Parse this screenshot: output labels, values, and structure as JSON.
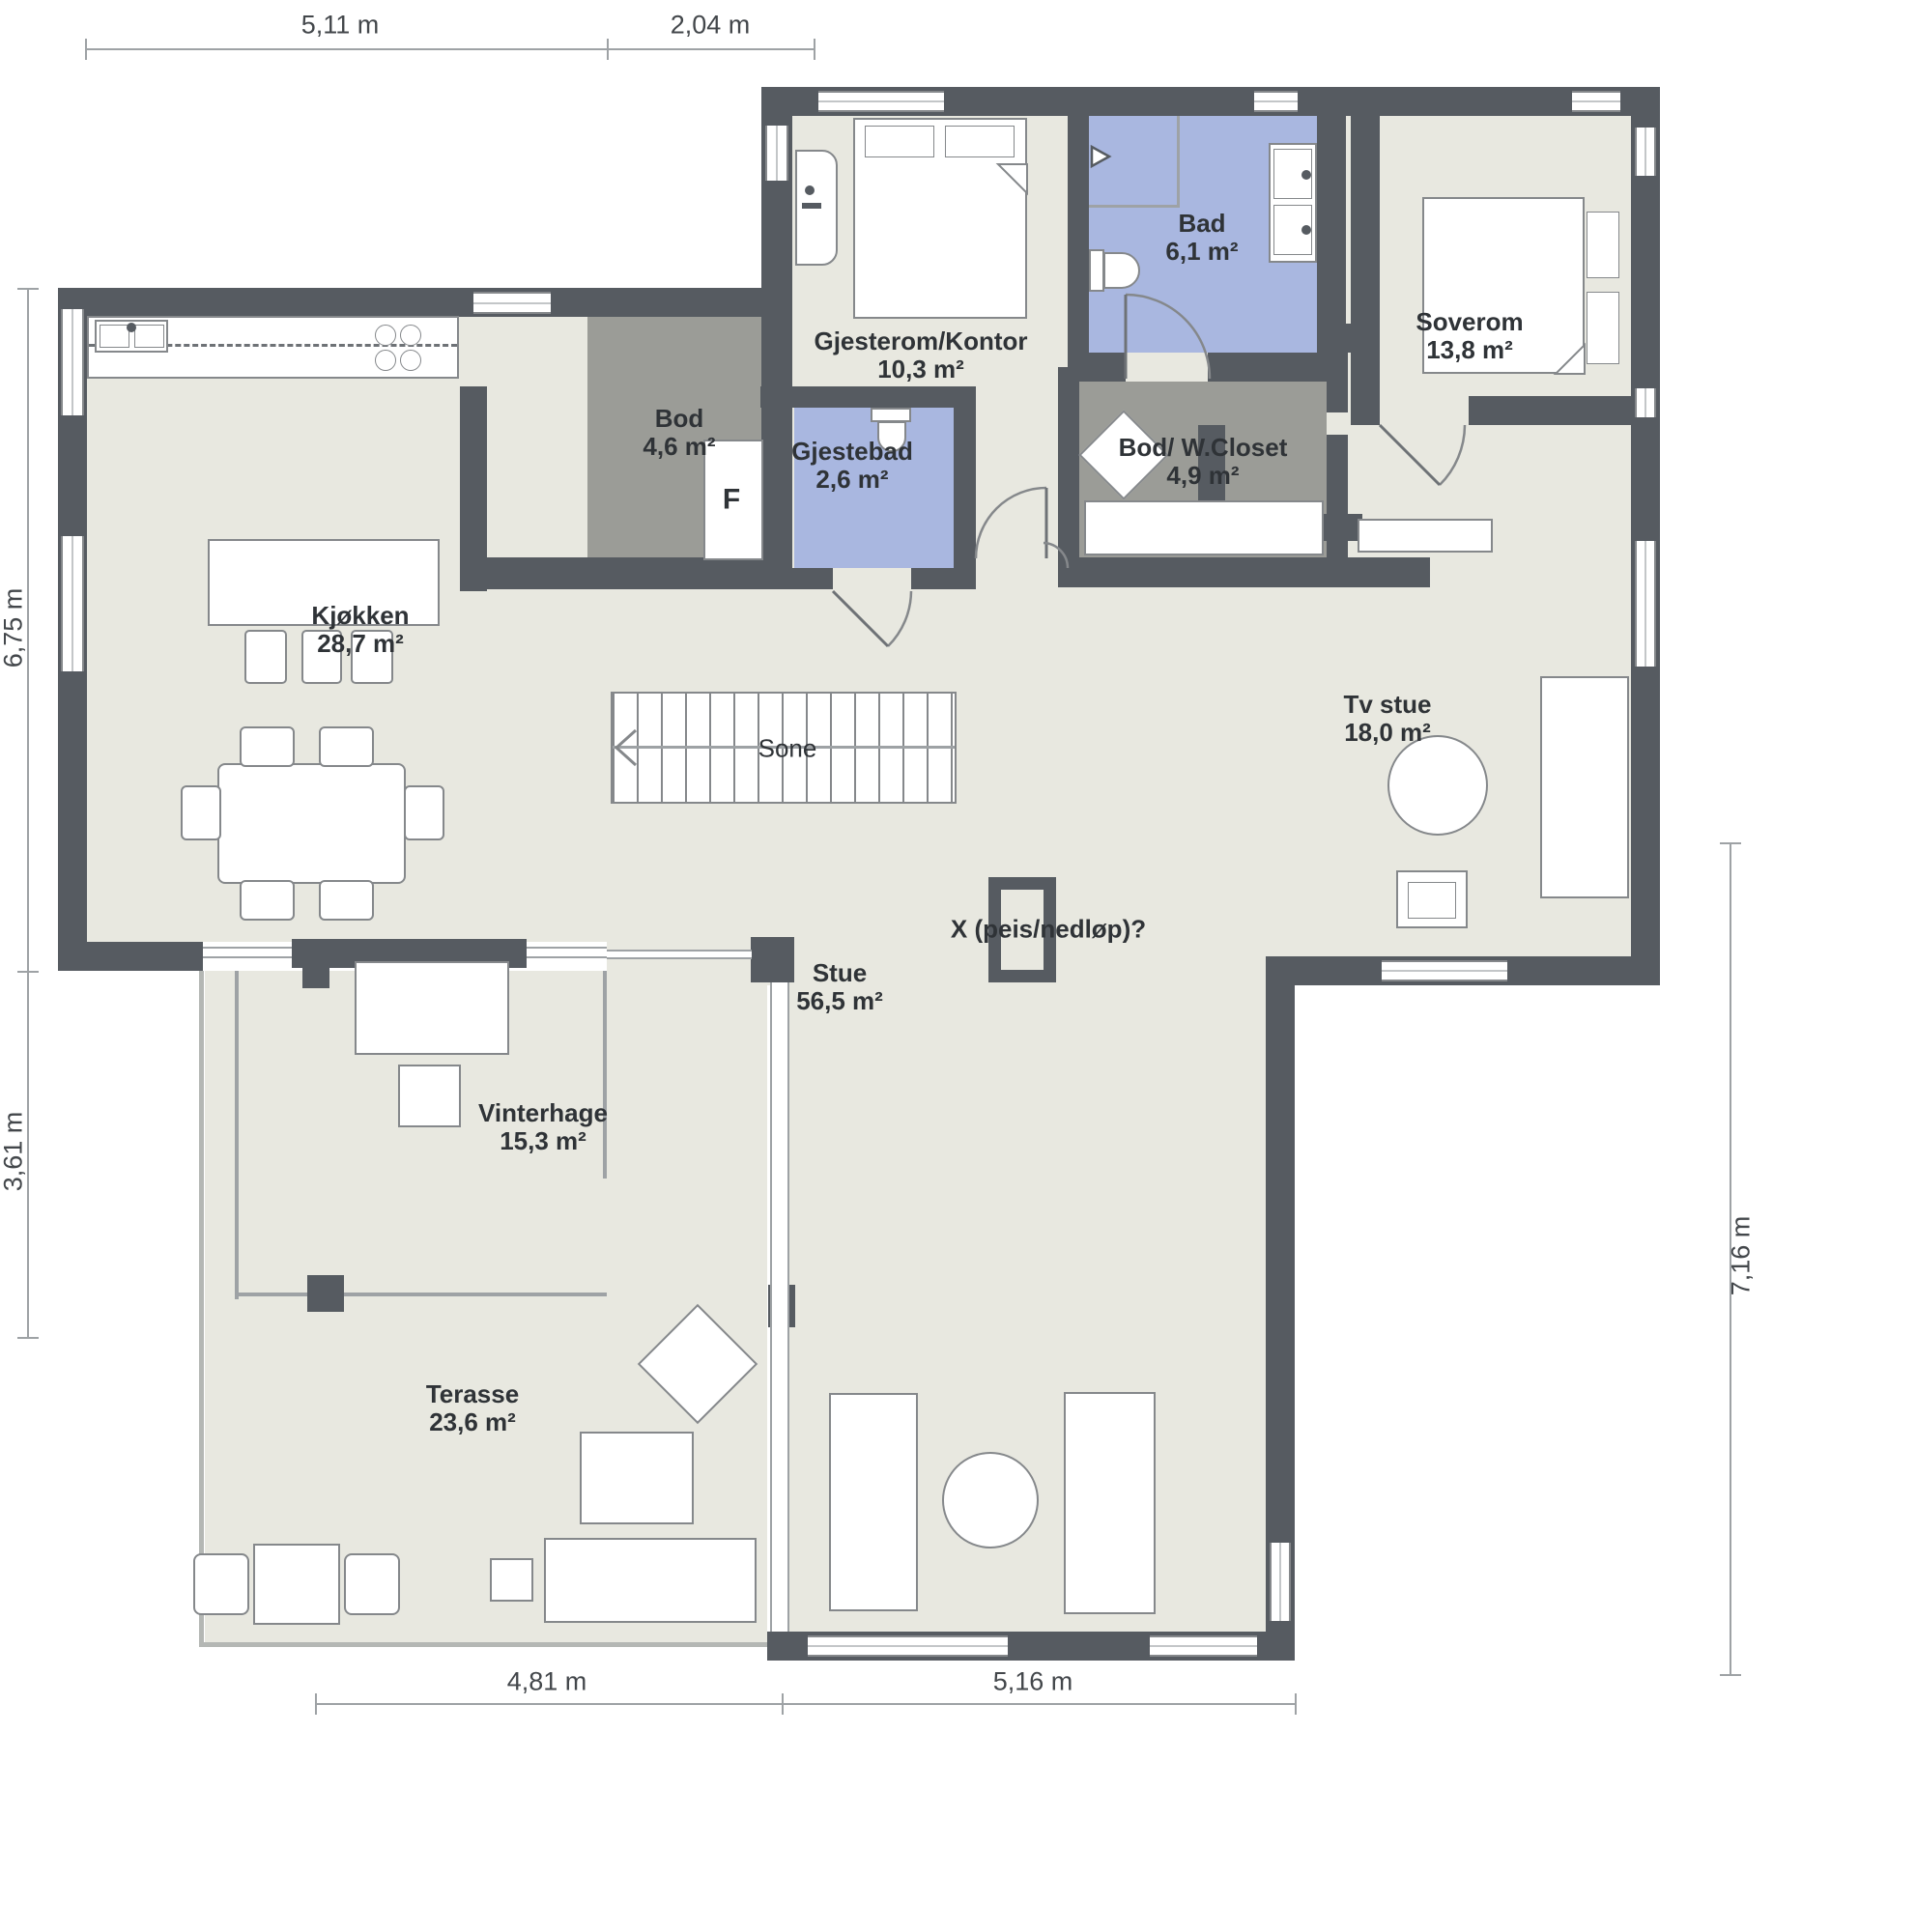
{
  "colors": {
    "wall": "#565b61",
    "floor": "#e8e8e0",
    "storage_room": "#9b9c97",
    "bathroom": "#a9b7e0",
    "furniture_line": "#85888b",
    "text": "#2f3337"
  },
  "rooms": [
    {
      "name": "Gjesterom/Kontor",
      "area": "10,3 m²"
    },
    {
      "name": "Bad",
      "area": "6,1 m²"
    },
    {
      "name": "Soverom",
      "area": "13,8 m²"
    },
    {
      "name": "Bod",
      "area": "4,6 m²"
    },
    {
      "name": "Gjestebad",
      "area": "2,6 m²"
    },
    {
      "name": "Bod/ W.Closet",
      "area": "4,9 m²"
    },
    {
      "name": "Kjøkken",
      "area": "28,7 m²"
    },
    {
      "name": "Tv stue",
      "area": "18,0 m²"
    },
    {
      "name": "Stue",
      "area": "56,5 m²"
    },
    {
      "name": "Vinterhage",
      "area": "15,3 m²"
    },
    {
      "name": "Terasse",
      "area": "23,6 m²"
    }
  ],
  "annotations": {
    "stair_direction": "Sone",
    "fireplace_note": "X (peis/nedløp)?",
    "freezer": "F"
  },
  "dimensions": {
    "top": [
      "5,11 m",
      "2,04 m"
    ],
    "left": [
      "6,75 m",
      "3,61 m"
    ],
    "right": [
      "7,16 m"
    ],
    "bottom": [
      "4,81 m",
      "5,16 m"
    ]
  }
}
